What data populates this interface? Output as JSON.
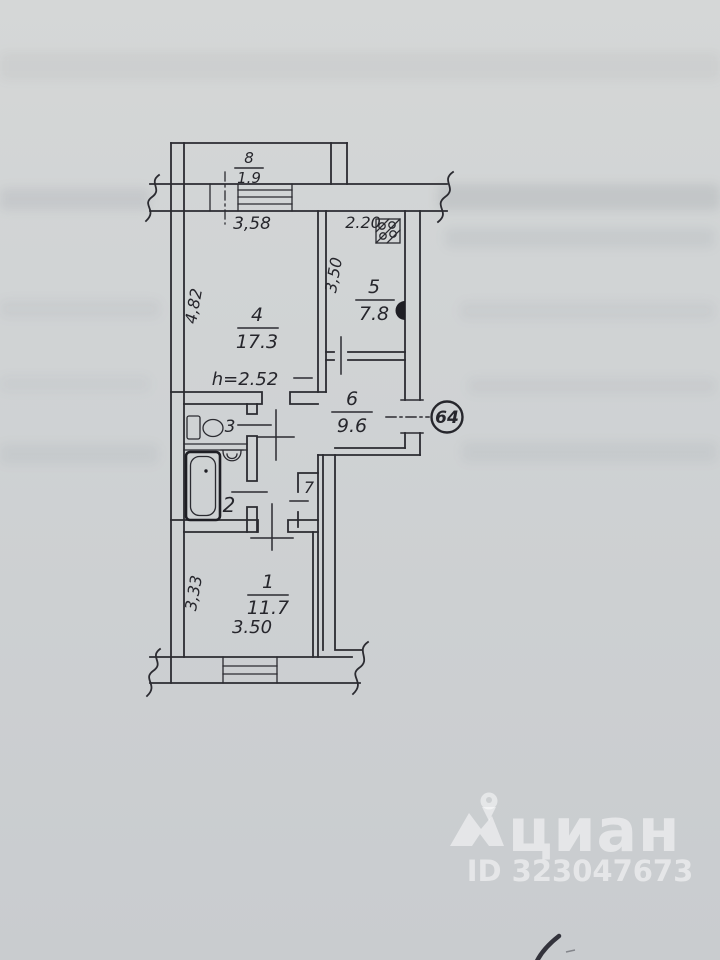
{
  "plan": {
    "apartment_number": "64",
    "ceiling_height": "h=2.52",
    "rooms": {
      "r1": {
        "number": "1",
        "area": "11.7"
      },
      "r2": {
        "number": "2"
      },
      "r3": {
        "number": "3"
      },
      "r4": {
        "number": "4",
        "area": "17.3"
      },
      "r5": {
        "number": "5",
        "area": "7.8"
      },
      "r6": {
        "number": "6",
        "area": "9.6"
      },
      "r7": {
        "number": "7"
      },
      "r8": {
        "number": "8",
        "area": "1.9"
      }
    },
    "dimensions": {
      "balcony_width": "3,58",
      "kitchen_width": "2.20",
      "room4_depth": "4,82",
      "kitchen_depth": "3,50",
      "room1_depth": "3,33",
      "room1_width": "3.50"
    }
  },
  "watermark": {
    "brand": "циан",
    "id_label": "ID 323047673"
  }
}
